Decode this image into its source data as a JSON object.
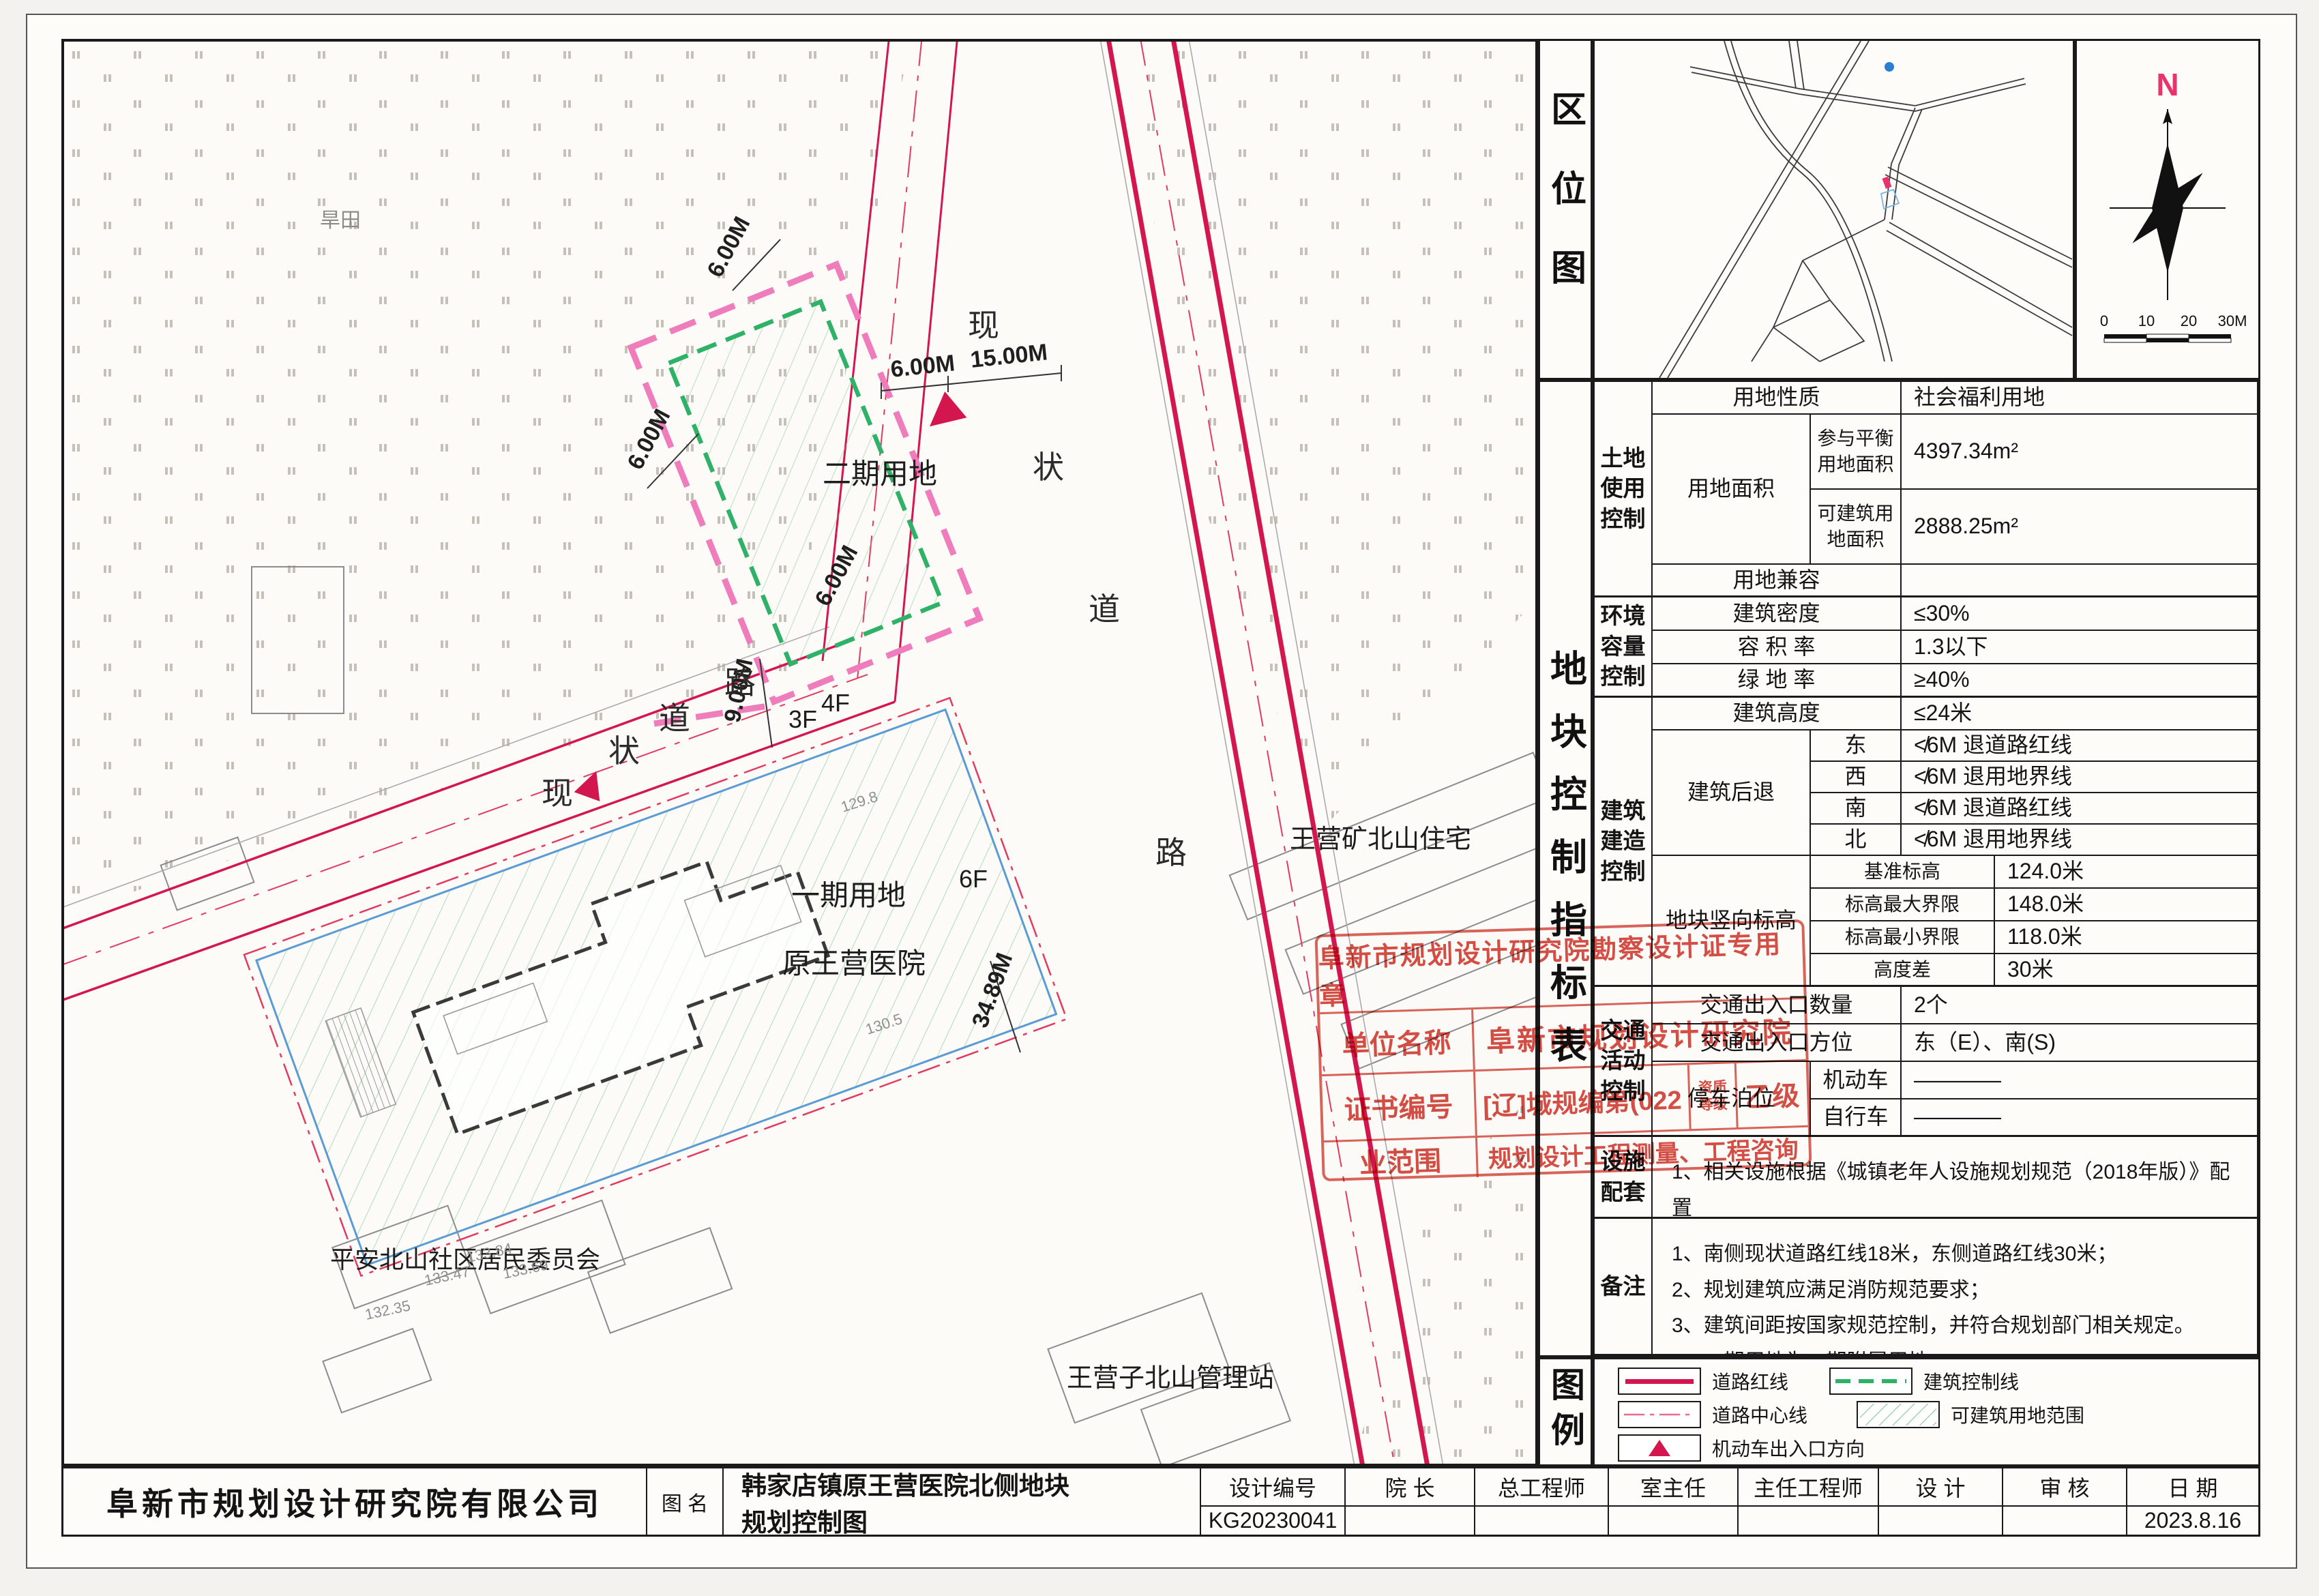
{
  "location_panel": {
    "title": "区位图",
    "north_label": "N",
    "scale": [
      "0",
      "10",
      "20",
      "30M"
    ]
  },
  "site_plan": {
    "labels": {
      "farmland": "旱田",
      "parcel2": "二期用地",
      "parcel1": "一期用地",
      "hospital": "原王营医院",
      "residence": "王营矿北山住宅",
      "committee": "平安北山社区居民委员会",
      "station": "王营子北山管理站"
    },
    "road_b": [
      "现",
      "状",
      "道",
      "路"
    ],
    "road_c": [
      "现",
      "状",
      "道",
      "路"
    ],
    "dims": {
      "d6": "6.00M",
      "d15": "15.00M",
      "d9": "9.00M",
      "d34": "34.89M"
    },
    "floors": {
      "f3": "3F",
      "f4": "4F",
      "f6": "6F"
    },
    "elevations": [
      "129.8",
      "130.5",
      "133.84",
      "133.47",
      "133.69",
      "132.35"
    ]
  },
  "indicator_table": {
    "title": "地块控制指标表",
    "land_use": {
      "category": "土地使用控制",
      "nature_label": "用地性质",
      "nature_value": "社会福利用地",
      "area_label": "用地面积",
      "balance_label": "参与平衡用地面积",
      "balance_value": "4397.34m²",
      "buildable_label": "可建筑用地面积",
      "buildable_value": "2888.25m²",
      "compat_label": "用地兼容",
      "compat_value": ""
    },
    "environment": {
      "category": "环境容量控制",
      "density_label": "建筑密度",
      "density_value": "≤30%",
      "far_label": "容 积 率",
      "far_value": "1.3以下",
      "green_label": "绿 地 率",
      "green_value": "≥40%"
    },
    "building": {
      "category": "建筑建造控制",
      "height_label": "建筑高度",
      "height_value": "≤24米",
      "setback_label": "建筑后退",
      "setbacks": [
        {
          "dir": "东",
          "value": "≮6M 退道路红线"
        },
        {
          "dir": "西",
          "value": "≮6M 退用地界线"
        },
        {
          "dir": "南",
          "value": "≮6M 退道路红线"
        },
        {
          "dir": "北",
          "value": "≮6M 退用地界线"
        }
      ],
      "vertical_label": "地块竖向标高",
      "verticals": [
        {
          "label": "基准标高",
          "value": "124.0米"
        },
        {
          "label": "标高最大界限",
          "value": "148.0米"
        },
        {
          "label": "标高最小界限",
          "value": "118.0米"
        },
        {
          "label": "高度差",
          "value": "30米"
        }
      ]
    },
    "traffic": {
      "category": "交通活动控制",
      "count_label": "交通出入口数量",
      "count_value": "2个",
      "dir_label": "交通出入口方位",
      "dir_value": "东（E）、南(S)",
      "parking_label": "停车泊位",
      "motor_label": "机动车",
      "motor_value": "————",
      "bike_label": "自行车",
      "bike_value": "————"
    },
    "facility": {
      "category": "设施配套",
      "content": "1、相关设施根据《城镇老年人设施规划规范（2018年版）》配置"
    },
    "remarks": {
      "category": "备注",
      "lines": [
        "1、南侧现状道路红线18米，东侧道路红线30米；",
        "2、规划建筑应满足消防规范要求；",
        "3、建筑间距按国家规范控制，并符合规划部门相关规定。",
        "4、二期用地为一期附属用地。"
      ]
    }
  },
  "legend": {
    "title": "图例",
    "items": [
      {
        "label": "道路红线"
      },
      {
        "label": "道路中心线"
      },
      {
        "label": "机动车出入口方向"
      },
      {
        "label": "建筑控制线"
      },
      {
        "label": "可建筑用地范围"
      }
    ]
  },
  "stamp": {
    "header": "阜新市规划设计研究院勘察设计证专用章",
    "unit_label": "单位名称",
    "unit_value": "阜新市规划设计研究院",
    "cert_label": "证书编号",
    "cert_value": "[辽]城规编第(022",
    "grade_label": "资质等级",
    "grade_value": "乙级",
    "scope_label": "业范围",
    "scope_value": "规划设计工程测量、工程咨询"
  },
  "title_block": {
    "company": "阜新市规划设计研究院有限公司",
    "name_label": "图 名",
    "title_line1": "韩家店镇原王营医院北侧地块",
    "title_line2": "规划控制图",
    "columns": [
      {
        "label": "设计编号",
        "value": "KG20230041"
      },
      {
        "label": "院 长",
        "value": ""
      },
      {
        "label": "总工程师",
        "value": ""
      },
      {
        "label": "室主任",
        "value": ""
      },
      {
        "label": "主任工程师",
        "value": ""
      },
      {
        "label": "设 计",
        "value": ""
      },
      {
        "label": "审 核",
        "value": ""
      },
      {
        "label": "日 期",
        "value": "2023.8.16"
      }
    ]
  }
}
